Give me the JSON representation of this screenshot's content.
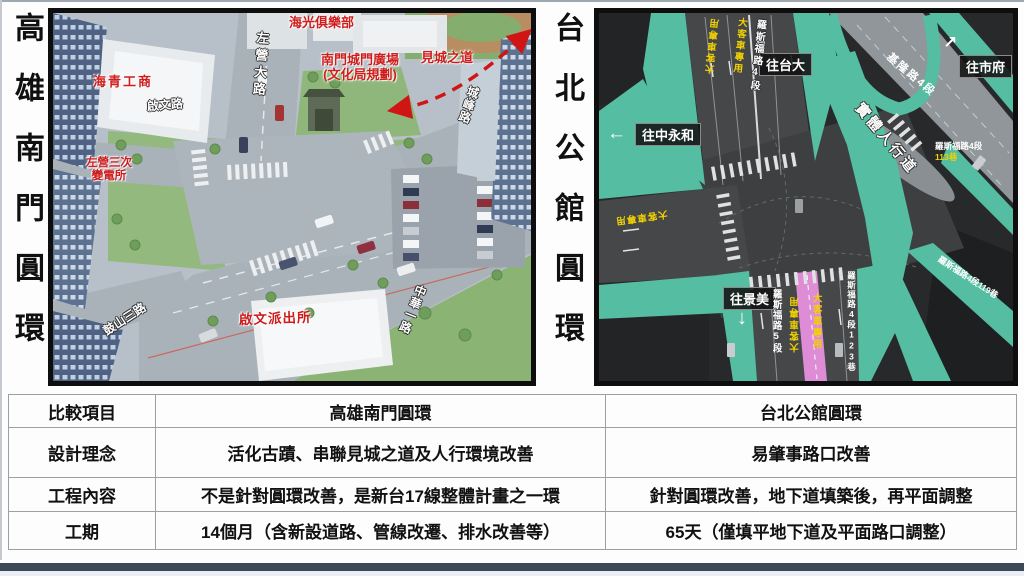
{
  "titles": {
    "left": "高雄南門圓環",
    "right": "台北公館圓環"
  },
  "kaohsiung": {
    "labels": {
      "haiguang_club": "海光俱樂部",
      "zuoying_rd": "左營大路",
      "gate_plaza_line1": "南門城門廣場",
      "gate_plaza_line2": "(文化局規劃)",
      "trail": "見城之道",
      "haiqing_school": "海青工商",
      "qiwen_rd": "啟文路",
      "substation_line1": "左營三次",
      "substation_line2": "變電所",
      "chengfeng_rd": "城峰路",
      "gushan_rd": "鼓山三路",
      "police": "啟文派出所",
      "zhonghua_rd": "中華一路"
    }
  },
  "taipei": {
    "labels": {
      "to_ntu": "往台大",
      "to_city_hall": "往市府",
      "to_zhongyonghe": "往中永和",
      "to_jingmei": "往景美",
      "roosevelt_4": "羅斯福路4段",
      "keelung_4": "基隆路4段",
      "sidewalk": "實體人行道",
      "lane_113_road": "羅斯福路4段",
      "lane_113": "113巷",
      "lane_119": "羅斯福路4段119巷",
      "lane_123": "羅斯福路4段123巷",
      "roosevelt_5": "羅斯福路5段",
      "bus_only": "大客車專用"
    },
    "arrows": {
      "ne": "↗",
      "w": "←",
      "s": "↓"
    }
  },
  "table": {
    "headers": {
      "item": "比較項目",
      "kaohsiung": "高雄南門圓環",
      "taipei": "台北公館圓環"
    },
    "rows": [
      {
        "item": "設計理念",
        "kaohsiung": "活化古蹟、串聯見城之道及人行環境改善",
        "taipei": "易肇事路口改善"
      },
      {
        "item": "工程內容",
        "kaohsiung": "不是針對圓環改善，是新台17線整體計畫之一環",
        "taipei": "針對圓環改善，地下道填築後，再平面調整"
      },
      {
        "item": "工期",
        "kaohsiung": "14個月（含新設道路、管線改遷、排水改善等）",
        "taipei": "65天（僅填平地下道及平面路口調整）"
      }
    ]
  },
  "colors": {
    "sidewalk_teal": "#55bda2",
    "bus_lane_pink": "#df8cd6",
    "lane_text_yellow": "#f2d200",
    "label_red": "#cf1d1d",
    "bottom_bar": "#3d4957"
  }
}
